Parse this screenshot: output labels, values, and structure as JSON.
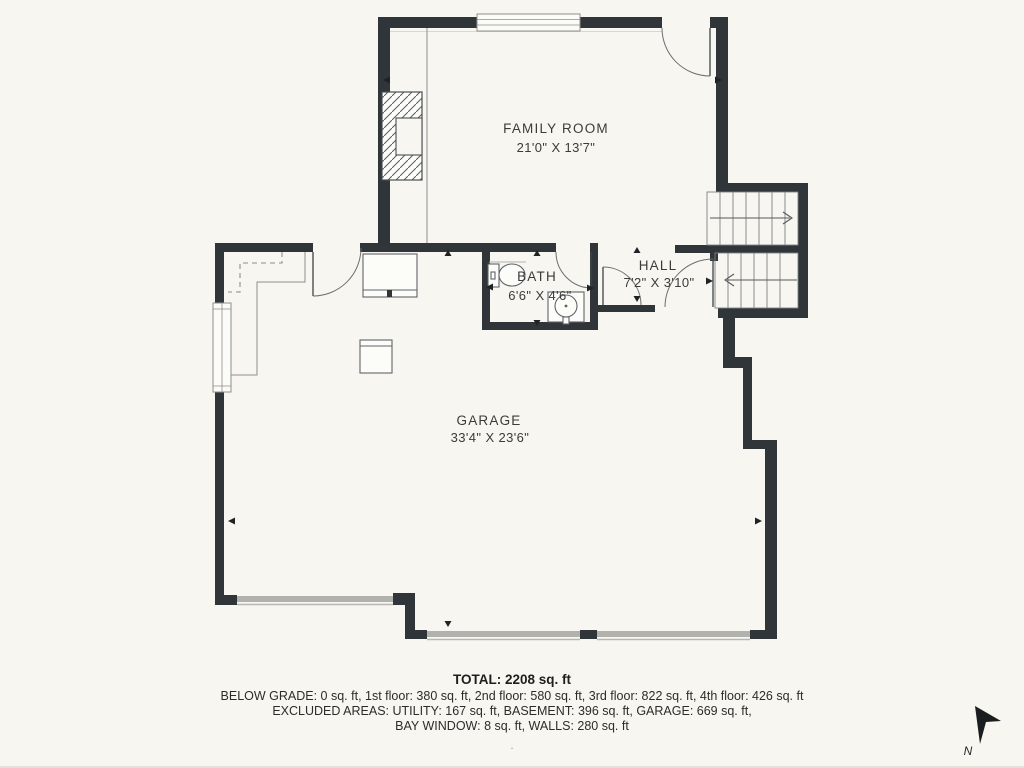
{
  "plan": {
    "rooms": [
      {
        "name": "FAMILY ROOM",
        "dimensions": "21'0\" X 13'7\""
      },
      {
        "name": "BATH",
        "dimensions": "6'6\" X 4'6\""
      },
      {
        "name": "HALL",
        "dimensions": "7'2\" X 3'10\""
      },
      {
        "name": "GARAGE",
        "dimensions": "33'4\" X 23'6\""
      }
    ]
  },
  "summary": {
    "total": "TOTAL: 2208 sq. ft",
    "below_grade": "BELOW GRADE: 0 sq. ft, 1st floor: 380 sq. ft, 2nd floor: 580 sq. ft, 3rd floor: 822 sq. ft, 4th floor: 426 sq. ft",
    "excluded": "EXCLUDED AREAS: UTILITY: 167 sq. ft, BASEMENT: 396 sq. ft, GARAGE: 669 sq. ft,",
    "bay": "BAY WINDOW: 8 sq. ft, WALLS: 280 sq. ft",
    "footnote": "."
  },
  "compass": {
    "label": "N"
  },
  "colors": {
    "background": "#f7f6f1",
    "wall": "#30353a",
    "line_gray": "#8f8f8c",
    "garage_door": "#b1b1ad",
    "text": "#3b3b39"
  }
}
